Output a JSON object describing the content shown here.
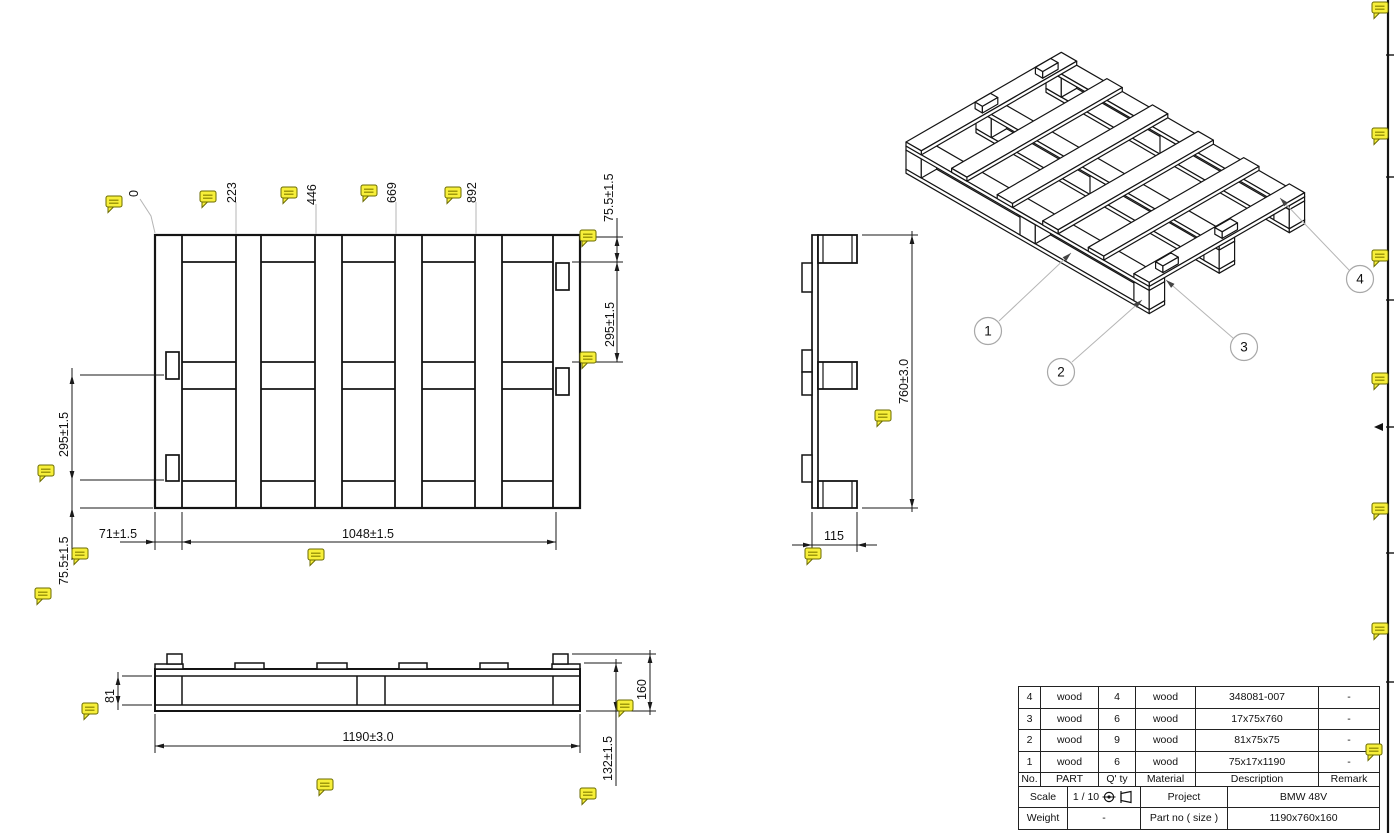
{
  "dimensions": {
    "top": {
      "positions": [
        "0",
        "223",
        "446",
        "669",
        "892"
      ]
    },
    "top_view": {
      "rail_height_right": "75.5±1.5",
      "gap_right": "295±1.5",
      "gap_left": "295±1.5",
      "rail_height_left": "75.5±1.5",
      "offset_left": "71±1.5",
      "span": "1048±1.5"
    },
    "side_view": {
      "depth": "760±3.0",
      "thickness": "115"
    },
    "front_view": {
      "length": "1190±3.0",
      "block_height": "81",
      "total_height": "160",
      "base_height": "132±1.5"
    }
  },
  "balloons": [
    "1",
    "2",
    "3",
    "4"
  ],
  "title_block": {
    "headers": {
      "no": "No.",
      "part": "PART",
      "qty": "Q' ty",
      "material": "Material",
      "description": "Description",
      "remark": "Remark"
    },
    "parts": [
      {
        "no": "4",
        "part": "wood",
        "qty": "4",
        "material": "wood",
        "description": "348081-007",
        "remark": "-"
      },
      {
        "no": "3",
        "part": "wood",
        "qty": "6",
        "material": "wood",
        "description": "17x75x760",
        "remark": "-"
      },
      {
        "no": "2",
        "part": "wood",
        "qty": "9",
        "material": "wood",
        "description": "81x75x75",
        "remark": "-"
      },
      {
        "no": "1",
        "part": "wood",
        "qty": "6",
        "material": "wood",
        "description": "75x17x1190",
        "remark": "-"
      }
    ],
    "scale_label": "Scale",
    "scale_value": "1 / 10",
    "project_label": "Project",
    "project_value": "BMW 48V",
    "weight_label": "Weight",
    "weight_value": "-",
    "partno_label": "Part no ( size )",
    "partno_value": "1190x760x160"
  },
  "annotations": {
    "comment_icon": "speech-bubble-note"
  },
  "colors": {
    "annotation_yellow": "#f7ef3a",
    "annotation_edge": "#6b6b00",
    "line_black": "#141414",
    "leader_gray": "#b5b5b5",
    "balloon_gray": "#a8a8a8"
  }
}
